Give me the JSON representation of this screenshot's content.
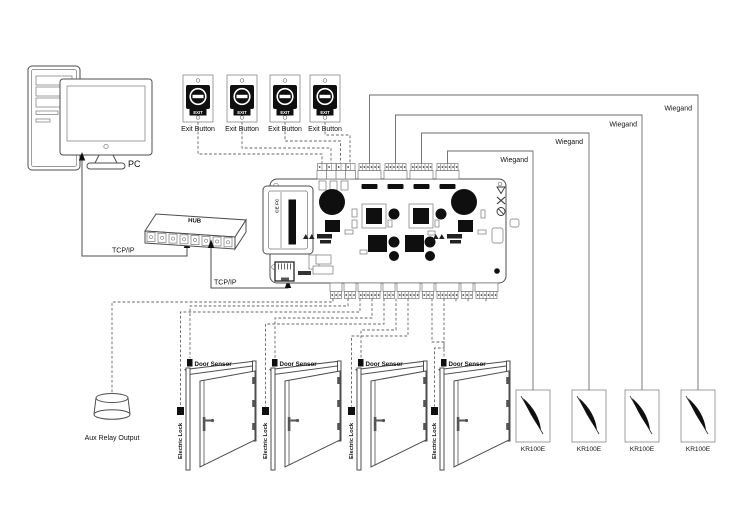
{
  "pc": {
    "label": "PC"
  },
  "hub": {
    "label": "HUB"
  },
  "tcpip": {
    "pc_hub_label": "TCP/IP",
    "hub_controller_label": "TCP/IP"
  },
  "exit_buttons": {
    "face_label": "EXIT",
    "items": [
      {
        "label": "Exit Button"
      },
      {
        "label": "Exit Button"
      },
      {
        "label": "Exit Button"
      },
      {
        "label": "Exit Button"
      }
    ]
  },
  "controller": {
    "cert_text": "CE FC"
  },
  "wiegand": {
    "items": [
      {
        "label": "Wiegand"
      },
      {
        "label": "Wiegand"
      },
      {
        "label": "Wiegand"
      },
      {
        "label": "Wiegand"
      }
    ]
  },
  "readers": {
    "items": [
      {
        "label": "KR100E"
      },
      {
        "label": "KR100E"
      },
      {
        "label": "KR100E"
      },
      {
        "label": "KR100E"
      }
    ]
  },
  "doors": {
    "items": [
      {
        "sensor_label": "Door Sensor",
        "lock_label": "Electric Lock"
      },
      {
        "sensor_label": "Door Sensor",
        "lock_label": "Electric Lock"
      },
      {
        "sensor_label": "Door Sensor",
        "lock_label": "Electric Lock"
      },
      {
        "sensor_label": "Door Sensor",
        "lock_label": "Electric Lock"
      }
    ]
  },
  "aux_relay": {
    "label": "Aux Relay Output"
  }
}
